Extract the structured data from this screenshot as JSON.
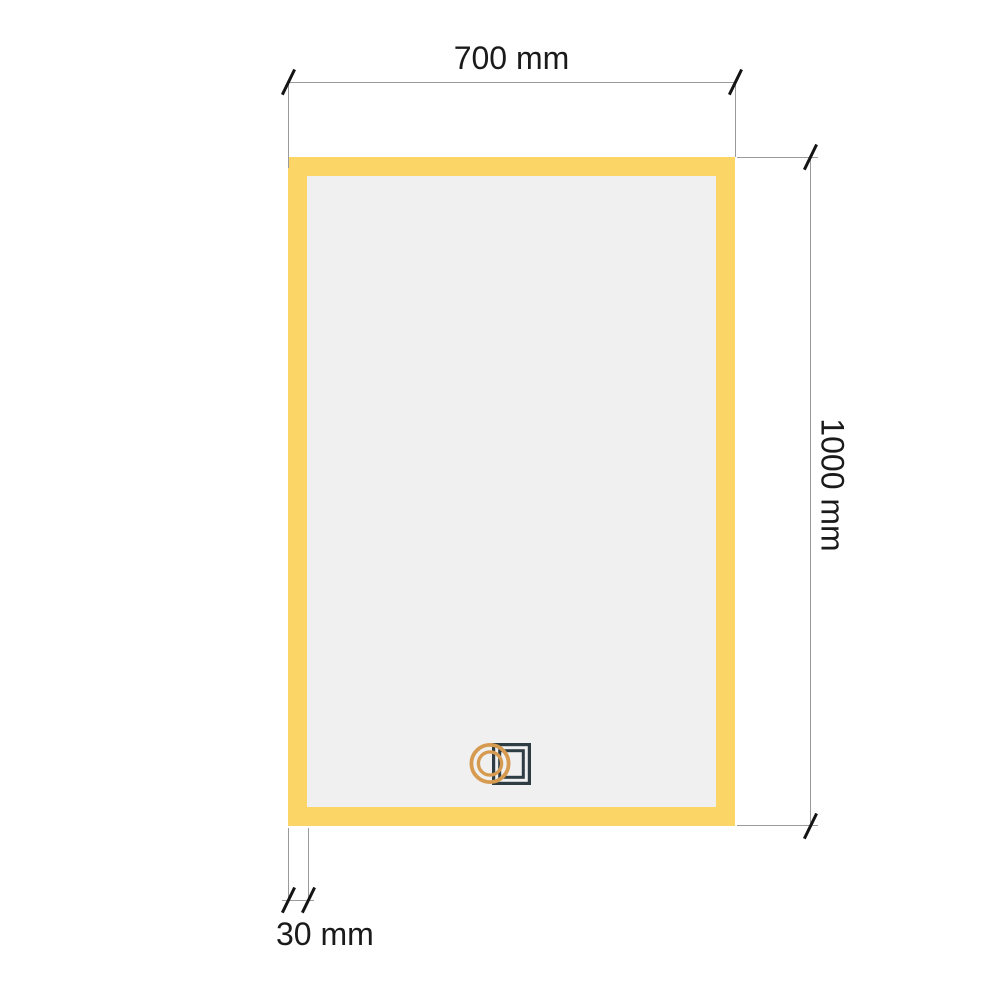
{
  "diagram": {
    "type": "technical-dimension-drawing",
    "subject": "led-mirror-front-view"
  },
  "labels": {
    "width": "700 mm",
    "height": "1000 mm",
    "frame": "30 mm"
  },
  "dimensions": {
    "width": {
      "value": 700,
      "unit": "mm"
    },
    "height": {
      "value": 1000,
      "unit": "mm"
    },
    "frame_thickness": {
      "value": 30,
      "unit": "mm"
    }
  },
  "icons": {
    "touch_sensor": "touch-sensor-icon"
  },
  "colors": {
    "frame_yellow": "#FBD565",
    "glass_gray": "#F0F0F1",
    "icon_ring": "#D69B50",
    "icon_square": "#2E3C43",
    "dim_line_gray": "#9B9B9B",
    "tick_black": "#141414",
    "text_black": "#1A1A1A",
    "background": "#FFFFFF"
  }
}
